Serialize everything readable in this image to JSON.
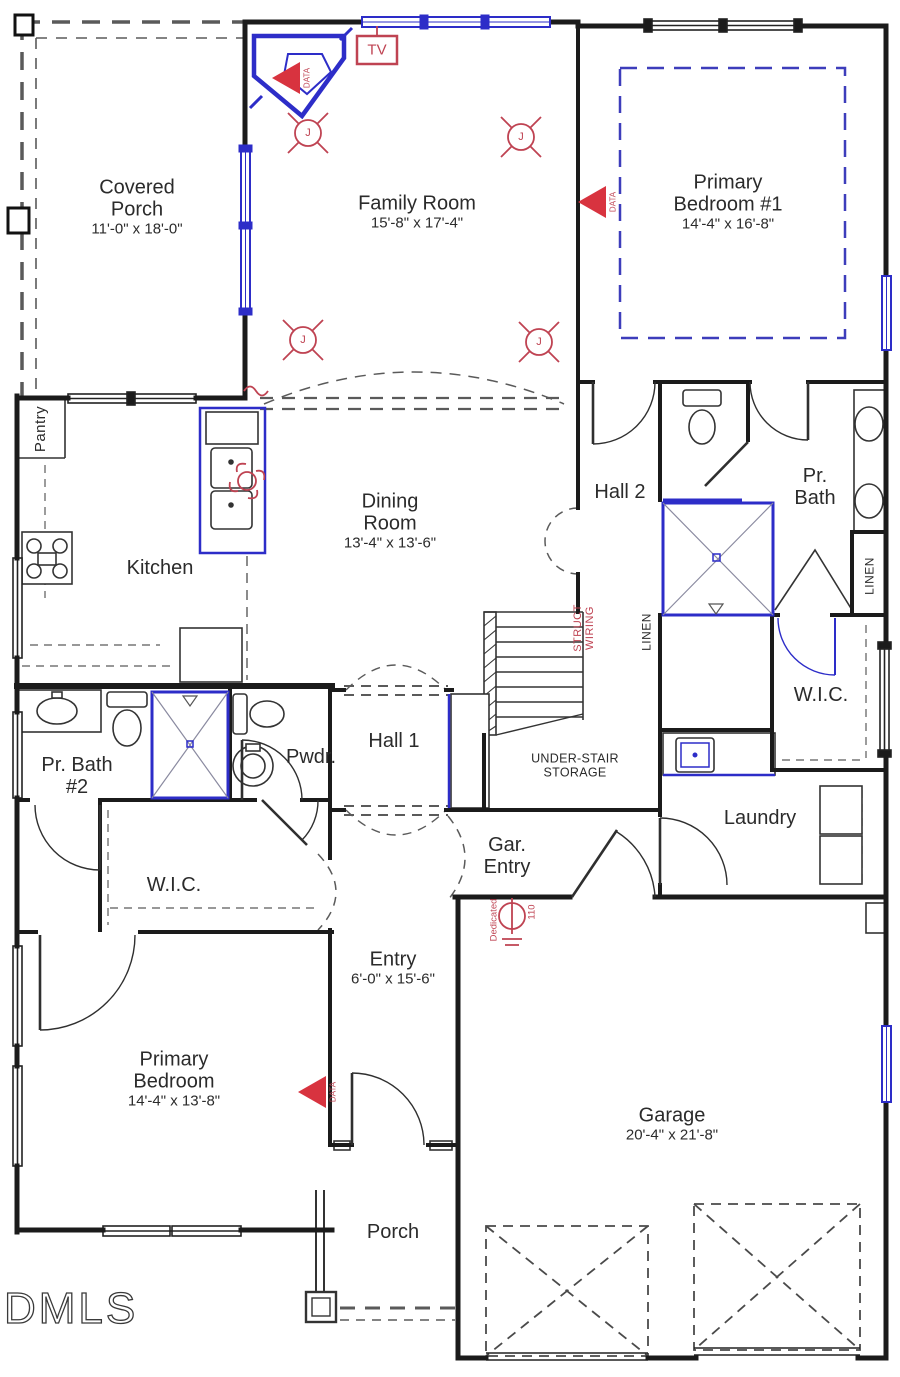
{
  "plan": {
    "watermark": "DMLS",
    "colors": {
      "wall": "#1b1b1b",
      "window_blue": "#2d2dc8",
      "electrical_red": "#bf4352",
      "label": "#2b2b2b"
    },
    "rooms": {
      "covered_porch": {
        "name": "Covered Porch",
        "dims": "11'-0\" x 18'-0\""
      },
      "family_room": {
        "name": "Family Room",
        "dims": "15'-8\" x 17'-4\""
      },
      "primary_bedroom_1": {
        "name": "Primary Bedroom #1",
        "dims": "14'-4\" x 16'-8\""
      },
      "pantry": {
        "name": "Pantry"
      },
      "kitchen": {
        "name": "Kitchen"
      },
      "dining_room": {
        "name": "Dining Room",
        "dims": "13'-4\" x 13'-6\""
      },
      "hall_2": {
        "name": "Hall 2"
      },
      "pr_bath": {
        "name": "Pr. Bath"
      },
      "linen_right": {
        "name": "LINEN"
      },
      "linen_left": {
        "name": "LINEN"
      },
      "wic_right": {
        "name": "W.I.C."
      },
      "under_stair": {
        "name": "UNDER-STAIR STORAGE"
      },
      "hall_1": {
        "name": "Hall 1"
      },
      "pwdr": {
        "name": "Pwdr."
      },
      "pr_bath_2": {
        "name": "Pr. Bath #2"
      },
      "laundry": {
        "name": "Laundry"
      },
      "wic_left": {
        "name": "W.I.C."
      },
      "gar_entry": {
        "name": "Gar. Entry"
      },
      "entry": {
        "name": "Entry",
        "dims": "6'-0\" x 15'-6\""
      },
      "primary_bedroom": {
        "name": "Primary Bedroom",
        "dims": "14'-4\" x 13'-8\""
      },
      "porch": {
        "name": "Porch"
      },
      "garage": {
        "name": "Garage",
        "dims": "20'-4\" x 21'-8\""
      }
    },
    "electrical": {
      "tv": "TV",
      "data": "DATA",
      "junction": "J",
      "struct_wiring_line1": "STRUCT",
      "struct_wiring_line2": "WIRING",
      "dedicated": "Dedicated",
      "amp": "110"
    }
  }
}
